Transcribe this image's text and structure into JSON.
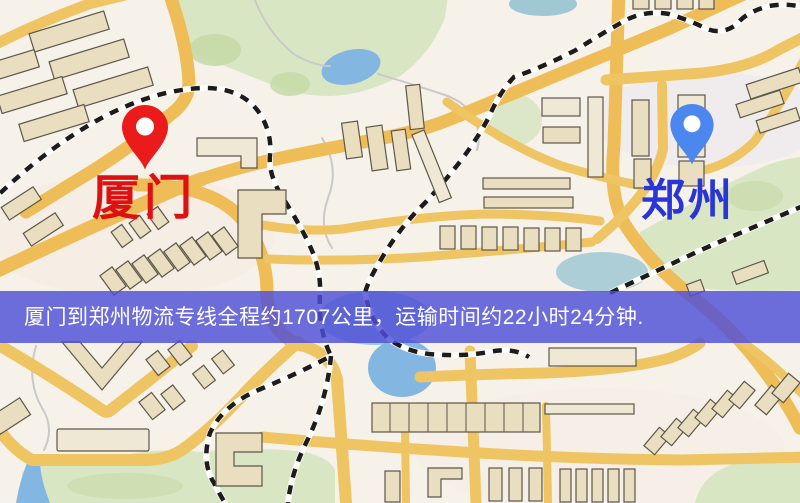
{
  "banner": {
    "text": "厦门到郑州物流专线全程约1707公里，运输时间约22小时24分钟.",
    "distance_km": "1707",
    "duration_hours": "22",
    "duration_minutes": "24",
    "background_color": "#4e4ed8",
    "text_color": "#ffffff"
  },
  "markers": {
    "origin": {
      "label": "厦门",
      "pin_color": "#ec1b1b",
      "label_color": "#dd1111"
    },
    "destination": {
      "label": "郑州",
      "pin_color": "#4c86ef",
      "label_color": "#2a35d8"
    }
  },
  "map": {
    "background_color": "#f6f1e9",
    "road_color": "#efc463",
    "park_color": "#d9e6c4",
    "water_color": "#84b6e2",
    "building_color": "#e9dfc0",
    "railway_color": "#1d1c1a"
  }
}
